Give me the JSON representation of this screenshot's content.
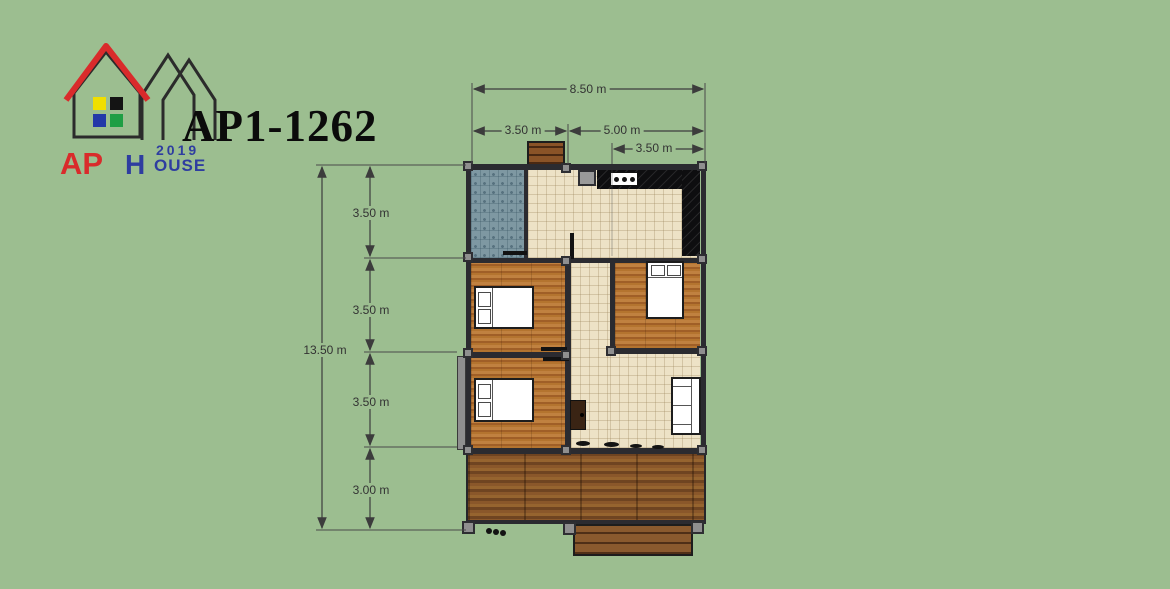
{
  "title": "AP1-1262",
  "logo": {
    "ap": "AP",
    "h": "H",
    "ouse": "OUSE",
    "year": "2019",
    "red": "#D92B2B",
    "blue": "#2E3DA0"
  },
  "dims": {
    "total_width": "8.50 m",
    "left_width": "3.50 m",
    "right_width": "5.00 m",
    "sub_right_width": "3.50 m",
    "total_height": "13.50 m",
    "seg1": "3.50 m",
    "seg2": "3.50 m",
    "seg3": "3.50 m",
    "seg4": "3.00 m"
  },
  "colors": {
    "background": "#9CBE90",
    "wall": "#2b2b30",
    "cream_floor": "#EDE2C6",
    "bathroom_tile": "#7E98A2",
    "bedroom_wood": "#AC6C2E",
    "deck_wood": "#7C4E26",
    "counter_marble": "#0E0E10",
    "dimension_text": "#333333",
    "logo_red": "#D92B2B",
    "logo_blue": "#2E3DA0",
    "post_gray": "#8f8f8f"
  }
}
